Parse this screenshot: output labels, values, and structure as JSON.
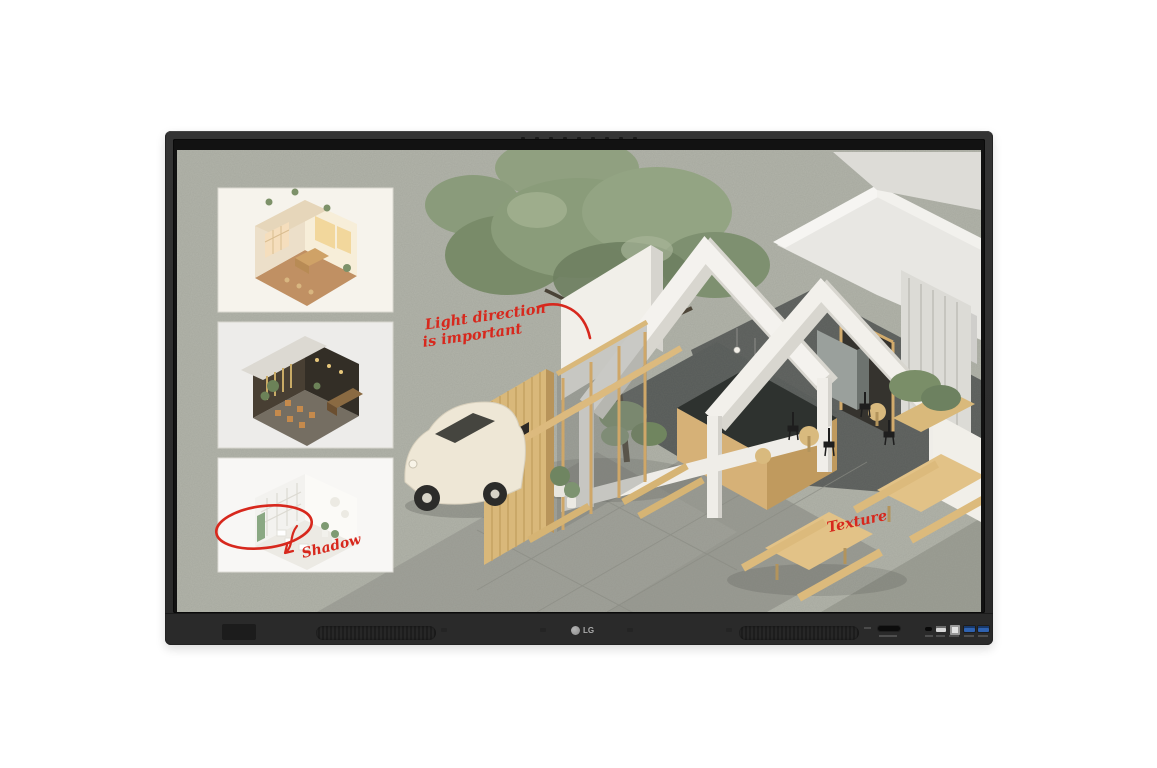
{
  "device": {
    "brand_logo": "LG",
    "type_label": "interactive touch display"
  },
  "screen": {
    "annotation_color": "#d7281d",
    "annotations": {
      "light_direction_line1": "Light direction",
      "light_direction_line2": "is important",
      "shadow_label": "Shadow",
      "texture_label": "Texture"
    },
    "cafe_sign": "CAFE",
    "thumbnails": [
      {
        "name": "warm-cafe-interior-render"
      },
      {
        "name": "dark-lounge-interior-render"
      },
      {
        "name": "bright-white-interior-render"
      }
    ],
    "palette": {
      "canvas_concrete": "#b2b4aa",
      "wall_white": "#f3f1ec",
      "wood": "#d8b77c",
      "foliage": "#86987",
      "dark_floor": "#5a5d5b"
    }
  }
}
